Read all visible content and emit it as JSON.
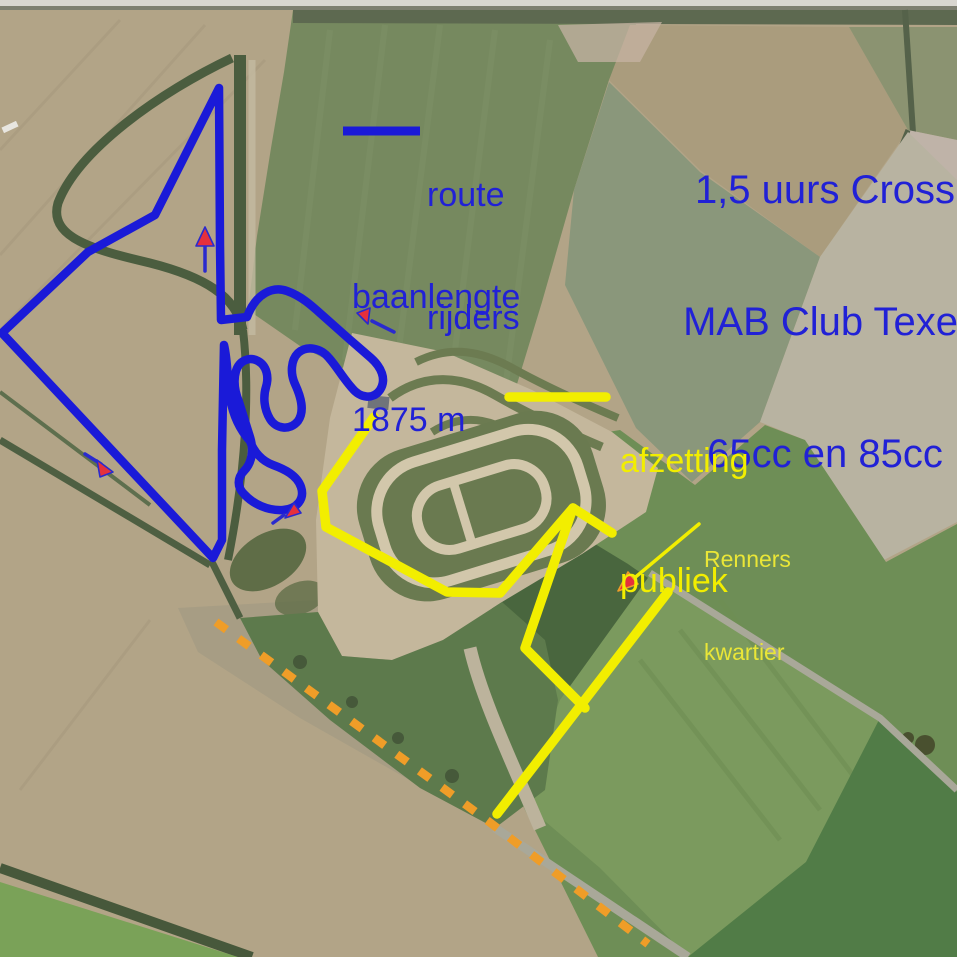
{
  "header": {
    "title_line1": "1,5 uurs Cross",
    "title_line2": "MAB Club Texel",
    "title_line3": "65cc en 85cc"
  },
  "legend": {
    "route_label_line1": "route",
    "route_label_line2": "rijders",
    "length_line1": "baanlengte",
    "length_line2": "1875 m",
    "public_line1": "afzetting",
    "public_line2": "publiek"
  },
  "annotations": {
    "renners_line1": "Renners",
    "renners_line2": "kwartier"
  },
  "colors": {
    "route_blue": "#1a1ad8",
    "heading_blue": "#2121d6",
    "barrier_yellow": "#f2ee00",
    "renners_yellow": "#eae637",
    "orange_dashed": "#ef9d28",
    "arrow_red": "#e5303c",
    "arrow_stem_blue": "#2a2ace"
  }
}
